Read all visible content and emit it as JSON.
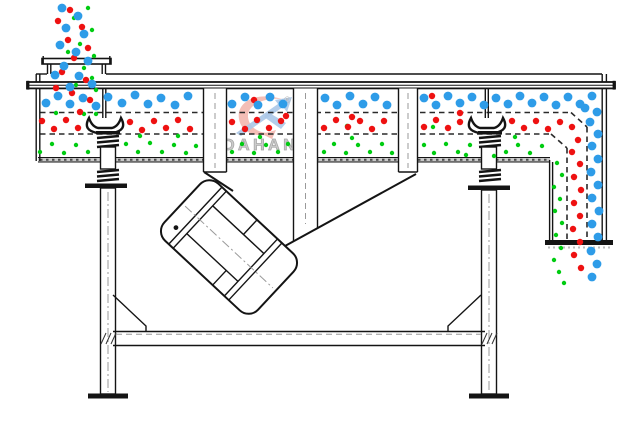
{
  "diagram": {
    "title": "linear-vibrating-screen-schematic",
    "watermark": {
      "text": "DAHAN",
      "registered": "®"
    },
    "colors": {
      "blue": "#2e9ce8",
      "red": "#ee1111",
      "green": "#00cc11",
      "watermark_red": "#f3b7ae",
      "watermark_blue": "#abc8e8",
      "watermark_text": "#cbcbcb",
      "watermark_text_stroke": "#a8a8a8"
    },
    "particles": {
      "blue": {
        "radius": 4.4,
        "points": [
          [
            62,
            8
          ],
          [
            78,
            16
          ],
          [
            66,
            28
          ],
          [
            84,
            34
          ],
          [
            60,
            45
          ],
          [
            76,
            52
          ],
          [
            88,
            61
          ],
          [
            64,
            66
          ],
          [
            79,
            76
          ],
          [
            92,
            84
          ],
          [
            70,
            87
          ],
          [
            55,
            75
          ],
          [
            46,
            103
          ],
          [
            58,
            96
          ],
          [
            70,
            104
          ],
          [
            83,
            98
          ],
          [
            96,
            106
          ],
          [
            108,
            97
          ],
          [
            122,
            103
          ],
          [
            135,
            95
          ],
          [
            148,
            104
          ],
          [
            161,
            98
          ],
          [
            175,
            105
          ],
          [
            188,
            96
          ],
          [
            232,
            104
          ],
          [
            245,
            97
          ],
          [
            258,
            105
          ],
          [
            270,
            97
          ],
          [
            283,
            104
          ],
          [
            325,
            98
          ],
          [
            337,
            105
          ],
          [
            350,
            96
          ],
          [
            363,
            104
          ],
          [
            375,
            97
          ],
          [
            387,
            105
          ],
          [
            424,
            98
          ],
          [
            436,
            105
          ],
          [
            448,
            96
          ],
          [
            460,
            103
          ],
          [
            472,
            97
          ],
          [
            484,
            105
          ],
          [
            496,
            98
          ],
          [
            508,
            104
          ],
          [
            520,
            96
          ],
          [
            532,
            103
          ],
          [
            544,
            97
          ],
          [
            556,
            105
          ],
          [
            568,
            97
          ],
          [
            580,
            104
          ],
          [
            592,
            96
          ],
          [
            585,
            108
          ],
          [
            597,
            112
          ],
          [
            590,
            122
          ],
          [
            598,
            134
          ],
          [
            592,
            146
          ],
          [
            598,
            159
          ],
          [
            591,
            172
          ],
          [
            598,
            185
          ],
          [
            592,
            198
          ],
          [
            599,
            211
          ],
          [
            592,
            224
          ],
          [
            598,
            237
          ],
          [
            591,
            251
          ],
          [
            597,
            264
          ],
          [
            592,
            277
          ]
        ]
      },
      "red": {
        "radius": 3.2,
        "points": [
          [
            70,
            10
          ],
          [
            58,
            21
          ],
          [
            82,
            27
          ],
          [
            68,
            40
          ],
          [
            88,
            48
          ],
          [
            74,
            58
          ],
          [
            62,
            72
          ],
          [
            86,
            80
          ],
          [
            56,
            88
          ],
          [
            72,
            93
          ],
          [
            90,
            100
          ],
          [
            80,
            112
          ],
          [
            42,
            121
          ],
          [
            54,
            129
          ],
          [
            66,
            120
          ],
          [
            78,
            128
          ],
          [
            130,
            122
          ],
          [
            142,
            130
          ],
          [
            154,
            121
          ],
          [
            166,
            128
          ],
          [
            178,
            120
          ],
          [
            190,
            129
          ],
          [
            232,
            122
          ],
          [
            245,
            129
          ],
          [
            257,
            120
          ],
          [
            269,
            128
          ],
          [
            281,
            121
          ],
          [
            324,
            128
          ],
          [
            336,
            120
          ],
          [
            348,
            127
          ],
          [
            360,
            121
          ],
          [
            372,
            129
          ],
          [
            384,
            121
          ],
          [
            424,
            127
          ],
          [
            436,
            120
          ],
          [
            448,
            128
          ],
          [
            460,
            122
          ],
          [
            512,
            121
          ],
          [
            524,
            128
          ],
          [
            536,
            121
          ],
          [
            548,
            129
          ],
          [
            560,
            122
          ],
          [
            572,
            127
          ],
          [
            432,
            96
          ],
          [
            254,
            100
          ],
          [
            460,
            113
          ],
          [
            352,
            117
          ],
          [
            286,
            116
          ],
          [
            578,
            140
          ],
          [
            572,
            152
          ],
          [
            580,
            164
          ],
          [
            574,
            177
          ],
          [
            581,
            190
          ],
          [
            574,
            203
          ],
          [
            580,
            216
          ],
          [
            573,
            229
          ],
          [
            580,
            242
          ],
          [
            574,
            255
          ],
          [
            581,
            268
          ]
        ]
      },
      "green": {
        "radius": 2.2,
        "points": [
          [
            88,
            8
          ],
          [
            74,
            18
          ],
          [
            92,
            30
          ],
          [
            80,
            44
          ],
          [
            94,
            56
          ],
          [
            68,
            52
          ],
          [
            84,
            68
          ],
          [
            92,
            78
          ],
          [
            76,
            85
          ],
          [
            60,
            96
          ],
          [
            96,
            90
          ],
          [
            96,
            114
          ],
          [
            84,
            114
          ],
          [
            56,
            113
          ],
          [
            140,
            136
          ],
          [
            178,
            136
          ],
          [
            260,
            137
          ],
          [
            347,
            126
          ],
          [
            352,
            138
          ],
          [
            433,
            127
          ],
          [
            515,
            137
          ],
          [
            40,
            152
          ],
          [
            52,
            144
          ],
          [
            64,
            153
          ],
          [
            76,
            145
          ],
          [
            88,
            152
          ],
          [
            126,
            144
          ],
          [
            138,
            152
          ],
          [
            150,
            143
          ],
          [
            162,
            152
          ],
          [
            174,
            145
          ],
          [
            186,
            153
          ],
          [
            196,
            146
          ],
          [
            232,
            152
          ],
          [
            242,
            144
          ],
          [
            254,
            153
          ],
          [
            266,
            145
          ],
          [
            278,
            152
          ],
          [
            288,
            144
          ],
          [
            324,
            152
          ],
          [
            334,
            144
          ],
          [
            346,
            153
          ],
          [
            358,
            145
          ],
          [
            370,
            152
          ],
          [
            382,
            144
          ],
          [
            392,
            153
          ],
          [
            424,
            145
          ],
          [
            434,
            153
          ],
          [
            446,
            144
          ],
          [
            458,
            152
          ],
          [
            470,
            145
          ],
          [
            466,
            155
          ],
          [
            494,
            156
          ],
          [
            506,
            152
          ],
          [
            518,
            145
          ],
          [
            530,
            153
          ],
          [
            542,
            146
          ],
          [
            557,
            163
          ],
          [
            562,
            175
          ],
          [
            554,
            187
          ],
          [
            560,
            199
          ],
          [
            555,
            211
          ],
          [
            562,
            223
          ],
          [
            556,
            235
          ],
          [
            561,
            248
          ],
          [
            554,
            260
          ],
          [
            559,
            272
          ],
          [
            564,
            283
          ]
        ]
      }
    }
  }
}
